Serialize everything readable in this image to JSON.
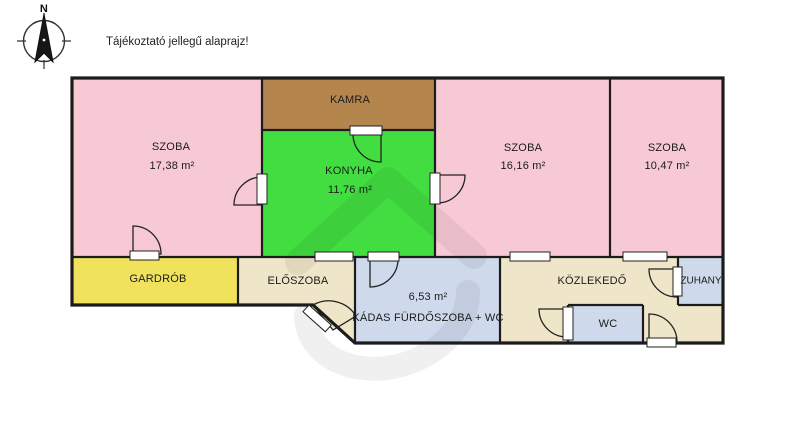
{
  "note": "Tájékoztató jellegű alaprajz!",
  "compass": {
    "north_label": "N"
  },
  "rooms": {
    "szoba1": {
      "name": "SZOBA",
      "area": "17,38 m²",
      "color": "#f7c9d5"
    },
    "kamra": {
      "name": "KAMRA",
      "color": "#b5854e"
    },
    "konyha": {
      "name": "KONYHA",
      "area": "11,76 m²",
      "color": "#42dd40"
    },
    "szoba2": {
      "name": "SZOBA",
      "area": "16,16 m²",
      "color": "#f7c9d5"
    },
    "szoba3": {
      "name": "SZOBA",
      "area": "10,47 m²",
      "color": "#f7c9d5"
    },
    "gardrob": {
      "name": "GARDRÓB",
      "color": "#f0e25c"
    },
    "eloszoba": {
      "name": "ELŐSZOBA",
      "color": "#efe5c8"
    },
    "furdoszoba": {
      "name": "KÁDAS FÜRDŐSZOBA + WC",
      "area": "6,53 m²",
      "color": "#cfd9ec"
    },
    "kozlekedo": {
      "name": "KÖZLEKEDŐ",
      "color": "#efe5c8"
    },
    "wc": {
      "name": "WC",
      "color": "#cfd9ec"
    },
    "zuhany": {
      "name": "ZUHANY",
      "color": "#cfd9ec"
    }
  },
  "palette": {
    "wall": "#1c1c1c",
    "door_leaf": "#ffffff",
    "background": "#ffffff",
    "text": "#1b1b1b"
  }
}
